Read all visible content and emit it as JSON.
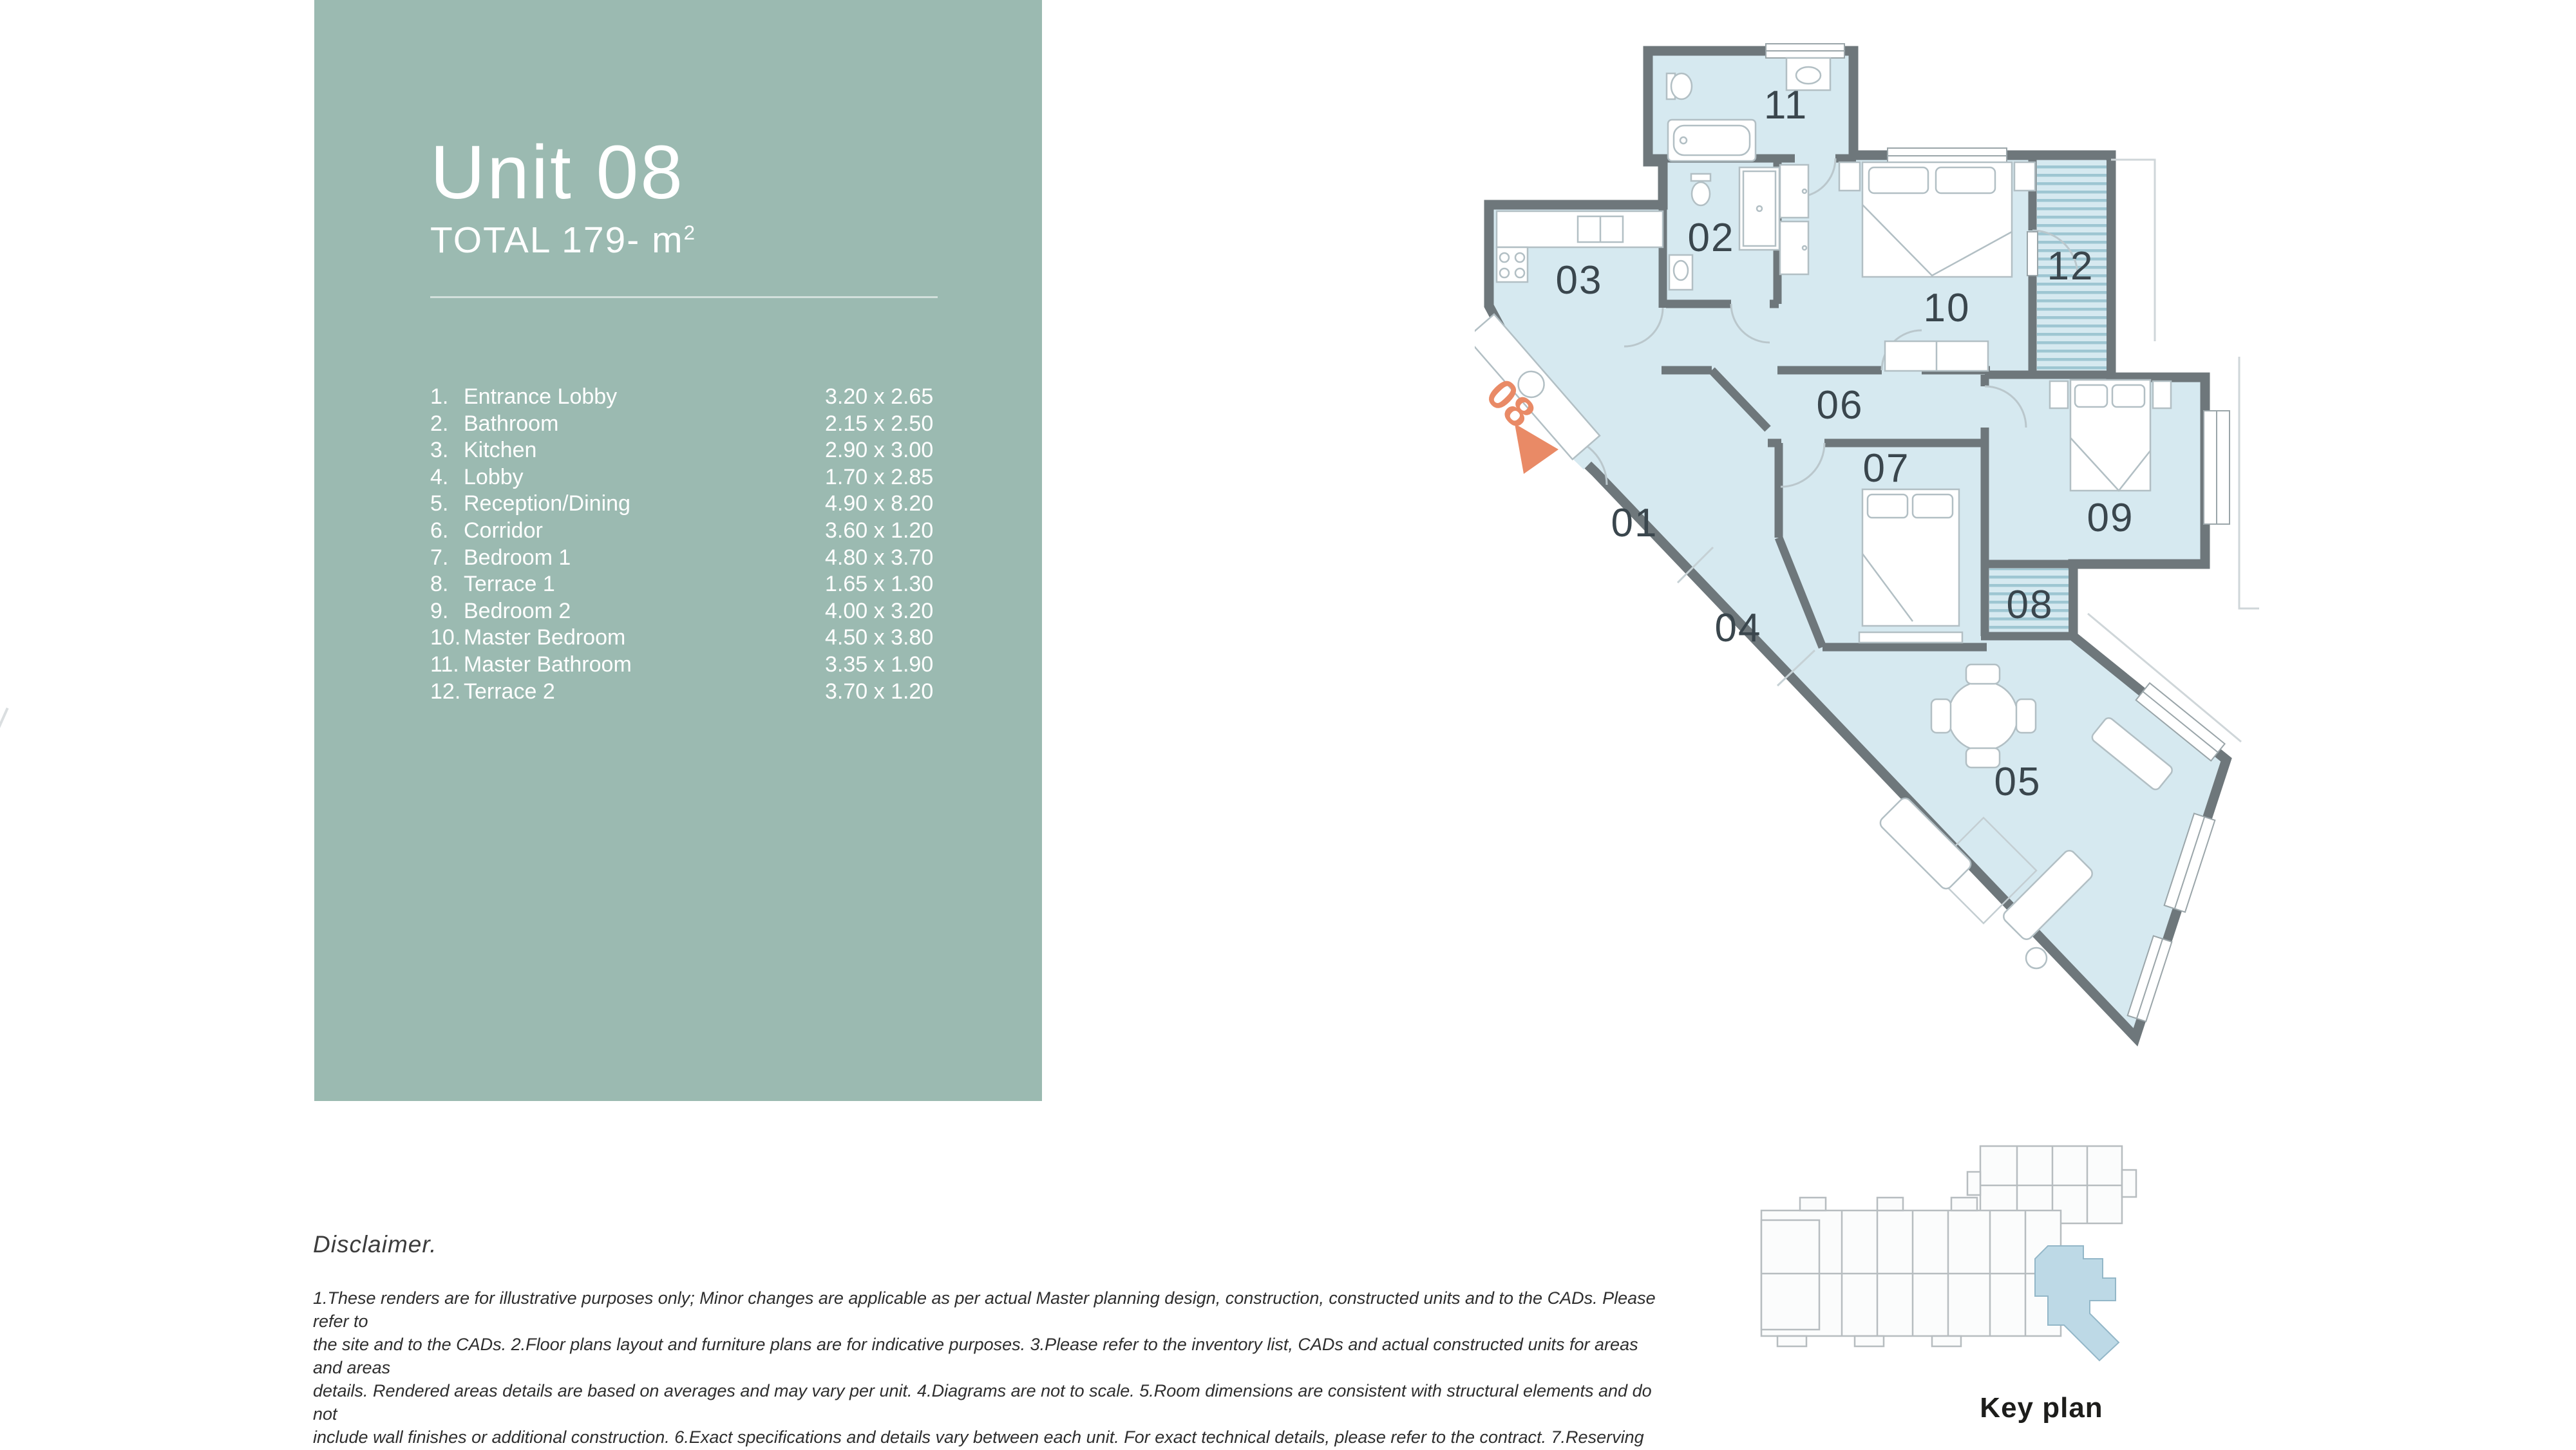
{
  "panel": {
    "title": "Unit 08",
    "total_label": "TOTAL 179- m",
    "total_sup": "2",
    "rooms": [
      {
        "num": "1.",
        "name": "Entrance Lobby",
        "dims": "3.20 x 2.65"
      },
      {
        "num": "2.",
        "name": "Bathroom",
        "dims": "2.15 x 2.50"
      },
      {
        "num": "3.",
        "name": "Kitchen",
        "dims": "2.90 x 3.00"
      },
      {
        "num": "4.",
        "name": "Lobby",
        "dims": "1.70 x 2.85"
      },
      {
        "num": "5.",
        "name": "Reception/Dining",
        "dims": "4.90 x 8.20"
      },
      {
        "num": "6.",
        "name": "Corridor",
        "dims": "3.60 x 1.20"
      },
      {
        "num": "7.",
        "name": "Bedroom 1",
        "dims": "4.80 x 3.70"
      },
      {
        "num": "8.",
        "name": "Terrace 1",
        "dims": "1.65 x 1.30"
      },
      {
        "num": "9.",
        "name": "Bedroom 2",
        "dims": "4.00 x 3.20"
      },
      {
        "num": "10.",
        "name": "Master Bedroom",
        "dims": "4.50 x 3.80"
      },
      {
        "num": "11.",
        "name": "Master Bathroom",
        "dims": "3.35 x 1.90"
      },
      {
        "num": "12.",
        "name": "Terrace 2",
        "dims": "3.70 x 1.20"
      }
    ]
  },
  "floor_plan": {
    "unit_marker": "08",
    "labels": {
      "r01": "01",
      "r02": "02",
      "r03": "03",
      "r04": "04",
      "r05": "05",
      "r06": "06",
      "r07": "07",
      "r08": "08",
      "r09": "09",
      "r10": "10",
      "r11": "11",
      "r12": "12"
    }
  },
  "key_plan": {
    "caption": "Key plan"
  },
  "disclaimer": {
    "heading": "Disclaimer.",
    "lines": [
      "1.These renders are for illustrative purposes only; Minor changes are applicable as per actual Master planning design, construction, constructed units and to the CADs. Please refer to",
      "the site and to the CADs. 2.Floor plans layout and furniture plans are for indicative purposes. 3.Please refer to the inventory list, CADs and actual constructed units for areas and areas",
      "details. Rendered areas details are based on averages and may vary per unit. 4.Diagrams are not to scale. 5.Room dimensions are consistent with structural elements and do not",
      "include wall finishes or additional construction. 6.Exact specifications and details vary between each unit. For exact technical details, please refer to the contract. 7.Reserving the right to",
      "make minor alterations to the drawings of 5% added or deducted from areas& values.5% added or deducted from areas& values."
    ]
  },
  "colors": {
    "panel_green": "#9bbab1",
    "floor_blue": "#d6e9f0",
    "wall_gray": "#6e777b",
    "accent_orange": "#e98a66",
    "terrace_stripe": "#9ec6d2",
    "keyplan_highlight": "#bdd9e6"
  }
}
